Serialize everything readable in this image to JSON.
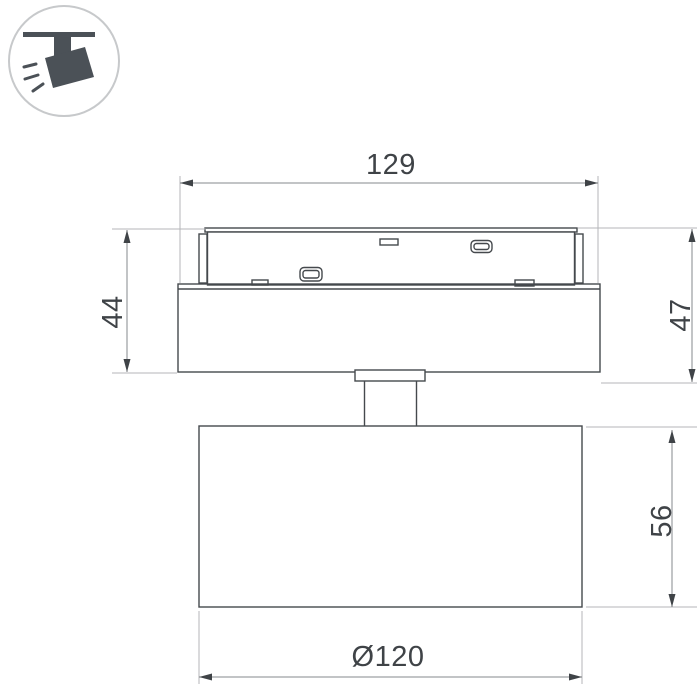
{
  "page": {
    "background": "#ffffff"
  },
  "badge_icon": {
    "name": "ceiling-track-spotlight",
    "glyph_color": "#4b5157",
    "circle_color": "#c7c9cb"
  },
  "drawing": {
    "line_color": "#45494d",
    "dim_line_color": "#86898c",
    "ext_line_color": "#b4b6b8",
    "text_color": "#3f4347",
    "dimensions": {
      "overall_width": "129",
      "housing_height": "44",
      "overall_height": "47",
      "lamp_height": "56",
      "lamp_diameter": "Ø120"
    }
  }
}
